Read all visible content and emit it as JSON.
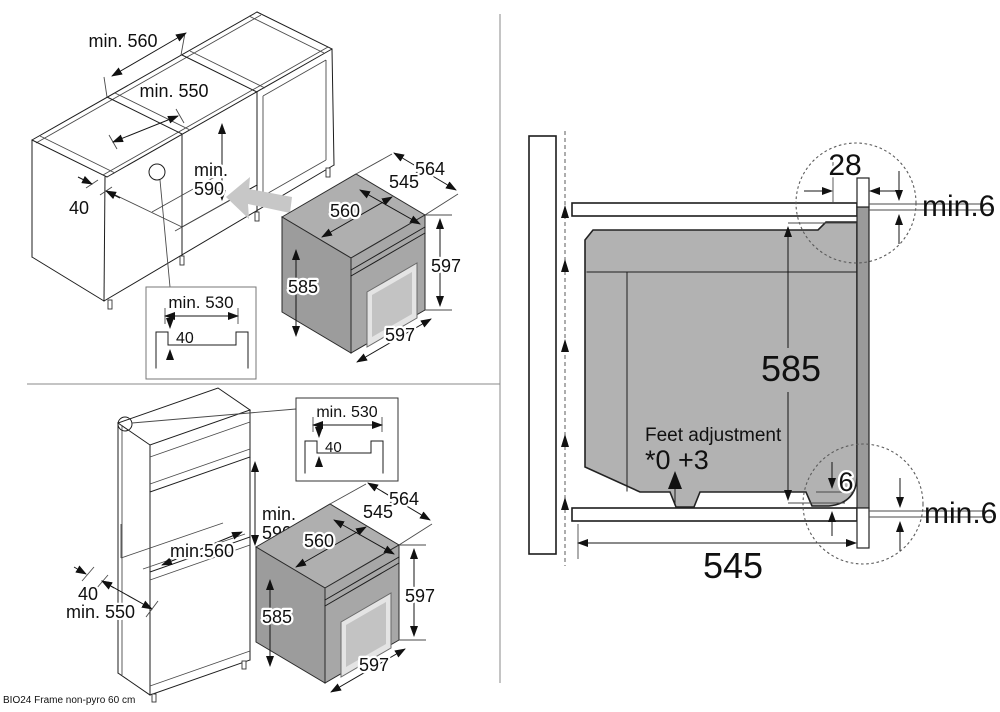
{
  "footer": {
    "note": "BIO24 Frame non-pyro 60 cm"
  },
  "colors": {
    "line": "#1d1d1d",
    "oven_gray": "#a7a7a7",
    "section_gray": "#b2b2b2",
    "arrow_gray": "#c7c7c7"
  },
  "top_left": {
    "width_label": "min. 560",
    "depth_label": "min. 550",
    "niche_height_label_1": "min.",
    "niche_height_label_2": "590",
    "rail_label": "40",
    "detail": {
      "width_label": "min. 530",
      "recess_label": "40"
    },
    "oven": {
      "depth_total": "564",
      "depth_top": "545",
      "width_top": "560",
      "height_body": "585",
      "height_front": "597",
      "width_front": "597"
    }
  },
  "bottom_left": {
    "rail_label": "40",
    "depth_label": "min. 550",
    "niche_width_label": "min.560",
    "niche_height_label_1": "min.",
    "niche_height_label_2": "590",
    "detail": {
      "width_label": "min. 530",
      "recess_label": "40"
    },
    "oven": {
      "depth_total": "564",
      "depth_top": "545",
      "width_top": "560",
      "height_body": "585",
      "height_front": "597",
      "width_front": "597"
    }
  },
  "right_section": {
    "front_gap_label": "28",
    "top_clearance_label": "min.6",
    "body_height_label": "585",
    "feet_title": "Feet adjustment",
    "feet_values": "*0 +3",
    "bottom_gap_label": "6",
    "bottom_clearance_label": "min.6",
    "niche_depth_label": "545"
  }
}
